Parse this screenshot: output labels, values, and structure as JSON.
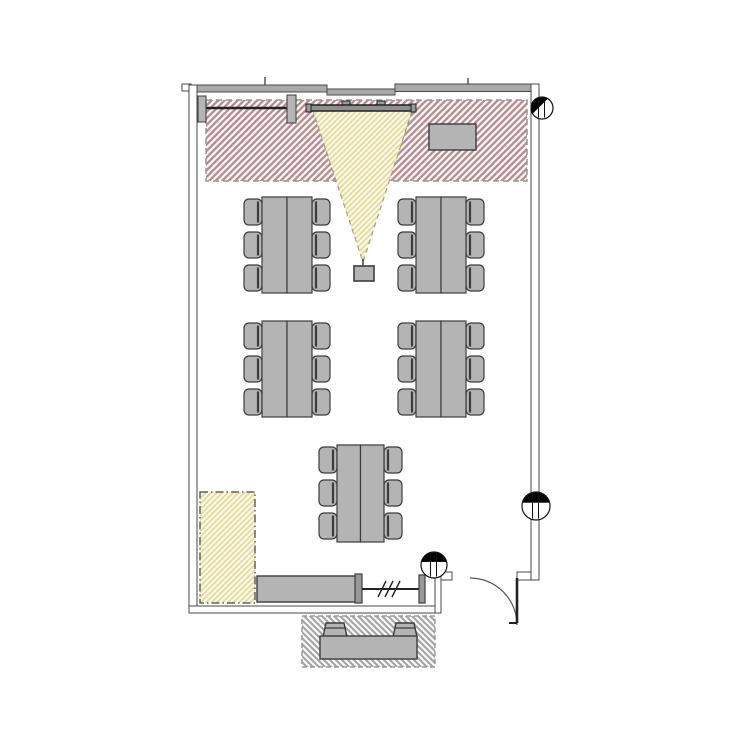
{
  "canvas": {
    "width": 750,
    "height": 750,
    "background": "#ffffff"
  },
  "colors": {
    "wall_line": "#4a4a4a",
    "wall_fill_window": "#a9a9a9",
    "wall_fill_plain": "#ffffff",
    "furniture_fill": "#b4b4b4",
    "furniture_fill_dark": "#999999",
    "furniture_line": "#3c3c3c",
    "screen_fill": "#8f8f8f",
    "screen_line": "#222222",
    "red_zone_line": "#b58e93",
    "red_zone_bg": "#fbf5f5",
    "red_zone_border": "#969696",
    "yellow_line": "#e4dda2",
    "yellow_bg": "#fdfbee",
    "cone_border": "#a8a06e",
    "storage_border": "#63635a",
    "ext_line": "#a6a6a6",
    "ext_bg": "#fbfbfb",
    "ext_border": "#9a9a9a",
    "door_line": "#222222",
    "arc_line": "#555555",
    "marker_line": "#111111",
    "marker_fill": "#000000"
  },
  "patterns": {
    "red": {
      "size": 6.5,
      "dir": "fwd",
      "stroke_key": "red_zone_line",
      "bg_key": "red_zone_bg",
      "width": 2.3
    },
    "yellow": {
      "size": 5.5,
      "dir": "fwd",
      "stroke_key": "yellow_line",
      "bg_key": "yellow_bg",
      "width": 2.0
    },
    "gray": {
      "size": 6.0,
      "dir": "back",
      "stroke_key": "ext_line",
      "bg_key": "ext_bg",
      "width": 2.2
    }
  },
  "walls": {
    "segments": [
      {
        "name": "wall-top-left-notch",
        "x": 182,
        "y": 84,
        "w": 9,
        "h": 7,
        "fill": "plain"
      },
      {
        "name": "wall-top-a",
        "x": 189,
        "y": 85,
        "w": 138,
        "h": 7,
        "fill": "window"
      },
      {
        "name": "wall-top-b",
        "x": 327,
        "y": 89,
        "w": 68,
        "h": 6,
        "fill": "window"
      },
      {
        "name": "wall-top-c",
        "x": 395,
        "y": 84,
        "w": 136,
        "h": 7.5,
        "fill": "window"
      },
      {
        "name": "wall-left",
        "x": 189,
        "y": 85,
        "w": 8,
        "h": 528,
        "fill": "plain"
      },
      {
        "name": "wall-right",
        "x": 531,
        "y": 84,
        "w": 8,
        "h": 496,
        "fill": "plain"
      },
      {
        "name": "wall-bottom",
        "x": 189,
        "y": 606,
        "w": 252,
        "h": 7,
        "fill": "plain"
      },
      {
        "name": "wall-step",
        "x": 435,
        "y": 572,
        "w": 6,
        "h": 41,
        "fill": "plain"
      },
      {
        "name": "wall-door-stub-left",
        "x": 441,
        "y": 572,
        "w": 11,
        "h": 8,
        "fill": "plain"
      },
      {
        "name": "wall-door-stub-right",
        "x": 517,
        "y": 572,
        "w": 14,
        "h": 8,
        "fill": "plain"
      }
    ],
    "window_ticks": [
      {
        "x1": 265,
        "y1": 77,
        "x2": 265,
        "y2": 85
      },
      {
        "x1": 468,
        "y1": 78,
        "x2": 468,
        "y2": 84
      }
    ]
  },
  "zones": [
    {
      "name": "presentation-zone",
      "x": 206,
      "y": 100,
      "w": 321,
      "h": 81,
      "pattern": "red",
      "border_key": "red_zone_border",
      "dash": "6 4"
    },
    {
      "name": "storage-zone",
      "x": 200,
      "y": 492,
      "w": 55,
      "h": 111,
      "pattern": "yellow",
      "border_key": "storage_border",
      "dash": "8 3 1.5 3"
    },
    {
      "name": "exterior-seating-zone",
      "x": 302,
      "y": 616,
      "w": 133,
      "h": 51,
      "pattern": "gray",
      "border_key": "ext_border",
      "dash": "5 3"
    }
  ],
  "projection": {
    "cone": {
      "points": [
        [
          313,
          111
        ],
        [
          412,
          111
        ],
        [
          363,
          262
        ]
      ],
      "dash": "5 4"
    },
    "screen": {
      "x": 307,
      "y": 105,
      "w": 108,
      "h": 6
    },
    "screen_caps": [
      {
        "x": 306,
        "y": 104,
        "w": 5,
        "h": 8
      },
      {
        "x": 411,
        "y": 104,
        "w": 5,
        "h": 8
      }
    ],
    "screen_brackets": [
      {
        "x": 342,
        "y": 101,
        "w": 8,
        "h": 5
      },
      {
        "x": 377,
        "y": 101,
        "w": 8,
        "h": 5
      }
    ],
    "projector": {
      "x": 354,
      "y": 266,
      "w": 20,
      "h": 15
    },
    "projector_tick": {
      "x1": 363,
      "y1": 259,
      "x2": 363,
      "y2": 266
    }
  },
  "whiteboard": {
    "rail": {
      "x1": 202,
      "y1": 108,
      "x2": 290,
      "y2": 108
    },
    "caps": [
      {
        "x": 198,
        "y": 96,
        "w": 8,
        "h": 26
      },
      {
        "x": 287,
        "y": 95,
        "w": 9,
        "h": 28
      }
    ]
  },
  "cabinet": {
    "x": 429,
    "y": 124,
    "w": 47,
    "h": 26
  },
  "seating": {
    "chair": {
      "w": 18,
      "h": 26,
      "gap": 7,
      "margin": 2
    },
    "table_groups": [
      {
        "name": "table-group-front-left",
        "x": 262,
        "y": 197,
        "table_w": 25,
        "table_h": 96
      },
      {
        "name": "table-group-front-right",
        "x": 416,
        "y": 197,
        "table_w": 25,
        "table_h": 96
      },
      {
        "name": "table-group-mid-left",
        "x": 262,
        "y": 321,
        "table_w": 25,
        "table_h": 96
      },
      {
        "name": "table-group-mid-right",
        "x": 416,
        "y": 321,
        "table_w": 25,
        "table_h": 96
      },
      {
        "name": "table-group-back-center",
        "x": 337,
        "y": 445,
        "table_w": 23.5,
        "table_h": 97
      }
    ]
  },
  "counter": {
    "body": {
      "x": 257,
      "y": 576,
      "w": 99,
      "h": 26
    },
    "cap": {
      "x": 355,
      "y": 574,
      "w": 7,
      "h": 29
    },
    "post": {
      "x": 419,
      "y": 575,
      "w": 6,
      "h": 28
    },
    "rail": {
      "x1": 362,
      "y1": 589,
      "x2": 419,
      "y2": 589
    },
    "slashes": [
      382,
      389,
      396
    ]
  },
  "door": {
    "leaf": {
      "x1": 517,
      "y1": 578,
      "x2": 517,
      "y2": 623
    },
    "arc": {
      "from": [
        470,
        578
      ],
      "to": [
        517,
        625
      ],
      "r": 47
    },
    "tick": {
      "x1": 509,
      "y1": 623,
      "x2": 517,
      "y2": 623
    }
  },
  "outdoor_bench": {
    "body": {
      "x": 320,
      "y": 636,
      "w": 97,
      "h": 23
    },
    "backs": [
      {
        "points": [
          [
            326,
            623
          ],
          [
            344,
            623
          ],
          [
            347,
            637
          ],
          [
            323,
            637
          ]
        ]
      },
      {
        "points": [
          [
            396,
            623
          ],
          [
            414,
            623
          ],
          [
            417,
            637
          ],
          [
            393,
            637
          ]
        ]
      }
    ]
  },
  "markers": [
    {
      "name": "column-marker-top-right",
      "cx": 542,
      "cy": 108,
      "r": 11,
      "rot": -45
    },
    {
      "name": "column-marker-right",
      "cx": 536,
      "cy": 506,
      "r": 14,
      "rot": 0
    },
    {
      "name": "column-marker-door",
      "cx": 434,
      "cy": 565,
      "r": 13,
      "rot": 0
    }
  ]
}
